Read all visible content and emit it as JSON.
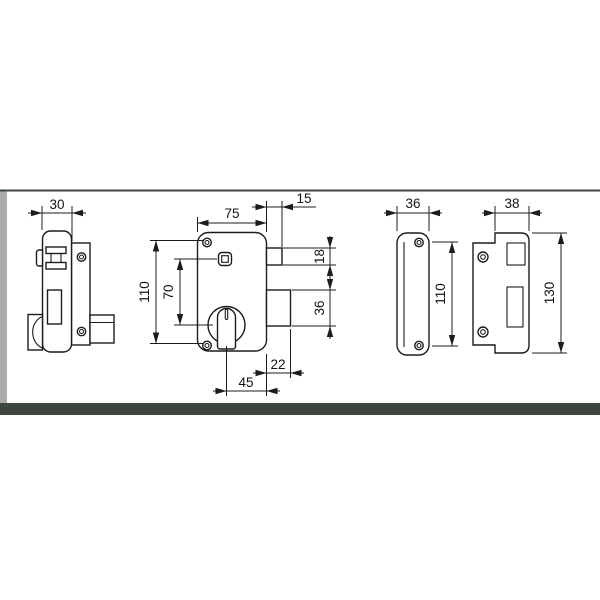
{
  "drawing": {
    "description": "technical dimension drawing of a vertical rim lock with cylinder and strike plates",
    "views": {
      "side_view": {
        "dims": {
          "depth": "30"
        }
      },
      "front_view": {
        "dims": {
          "width": "75",
          "latch_projection": "15",
          "latch_height": "18",
          "height": "110",
          "axis_distance": "70",
          "deadbolt_height": "36",
          "deadbolt_projection": "22",
          "backset": "45"
        }
      },
      "cover_plate": {
        "dims": {
          "width": "36",
          "fixing_centers": "110"
        }
      },
      "strike_plate": {
        "dims": {
          "width": "38",
          "height": "130"
        }
      }
    },
    "colors": {
      "line": "#1c1c1c",
      "background": "#ffffff",
      "frame_band": "#3d463f",
      "edge_strip": "#a9aca9"
    }
  }
}
